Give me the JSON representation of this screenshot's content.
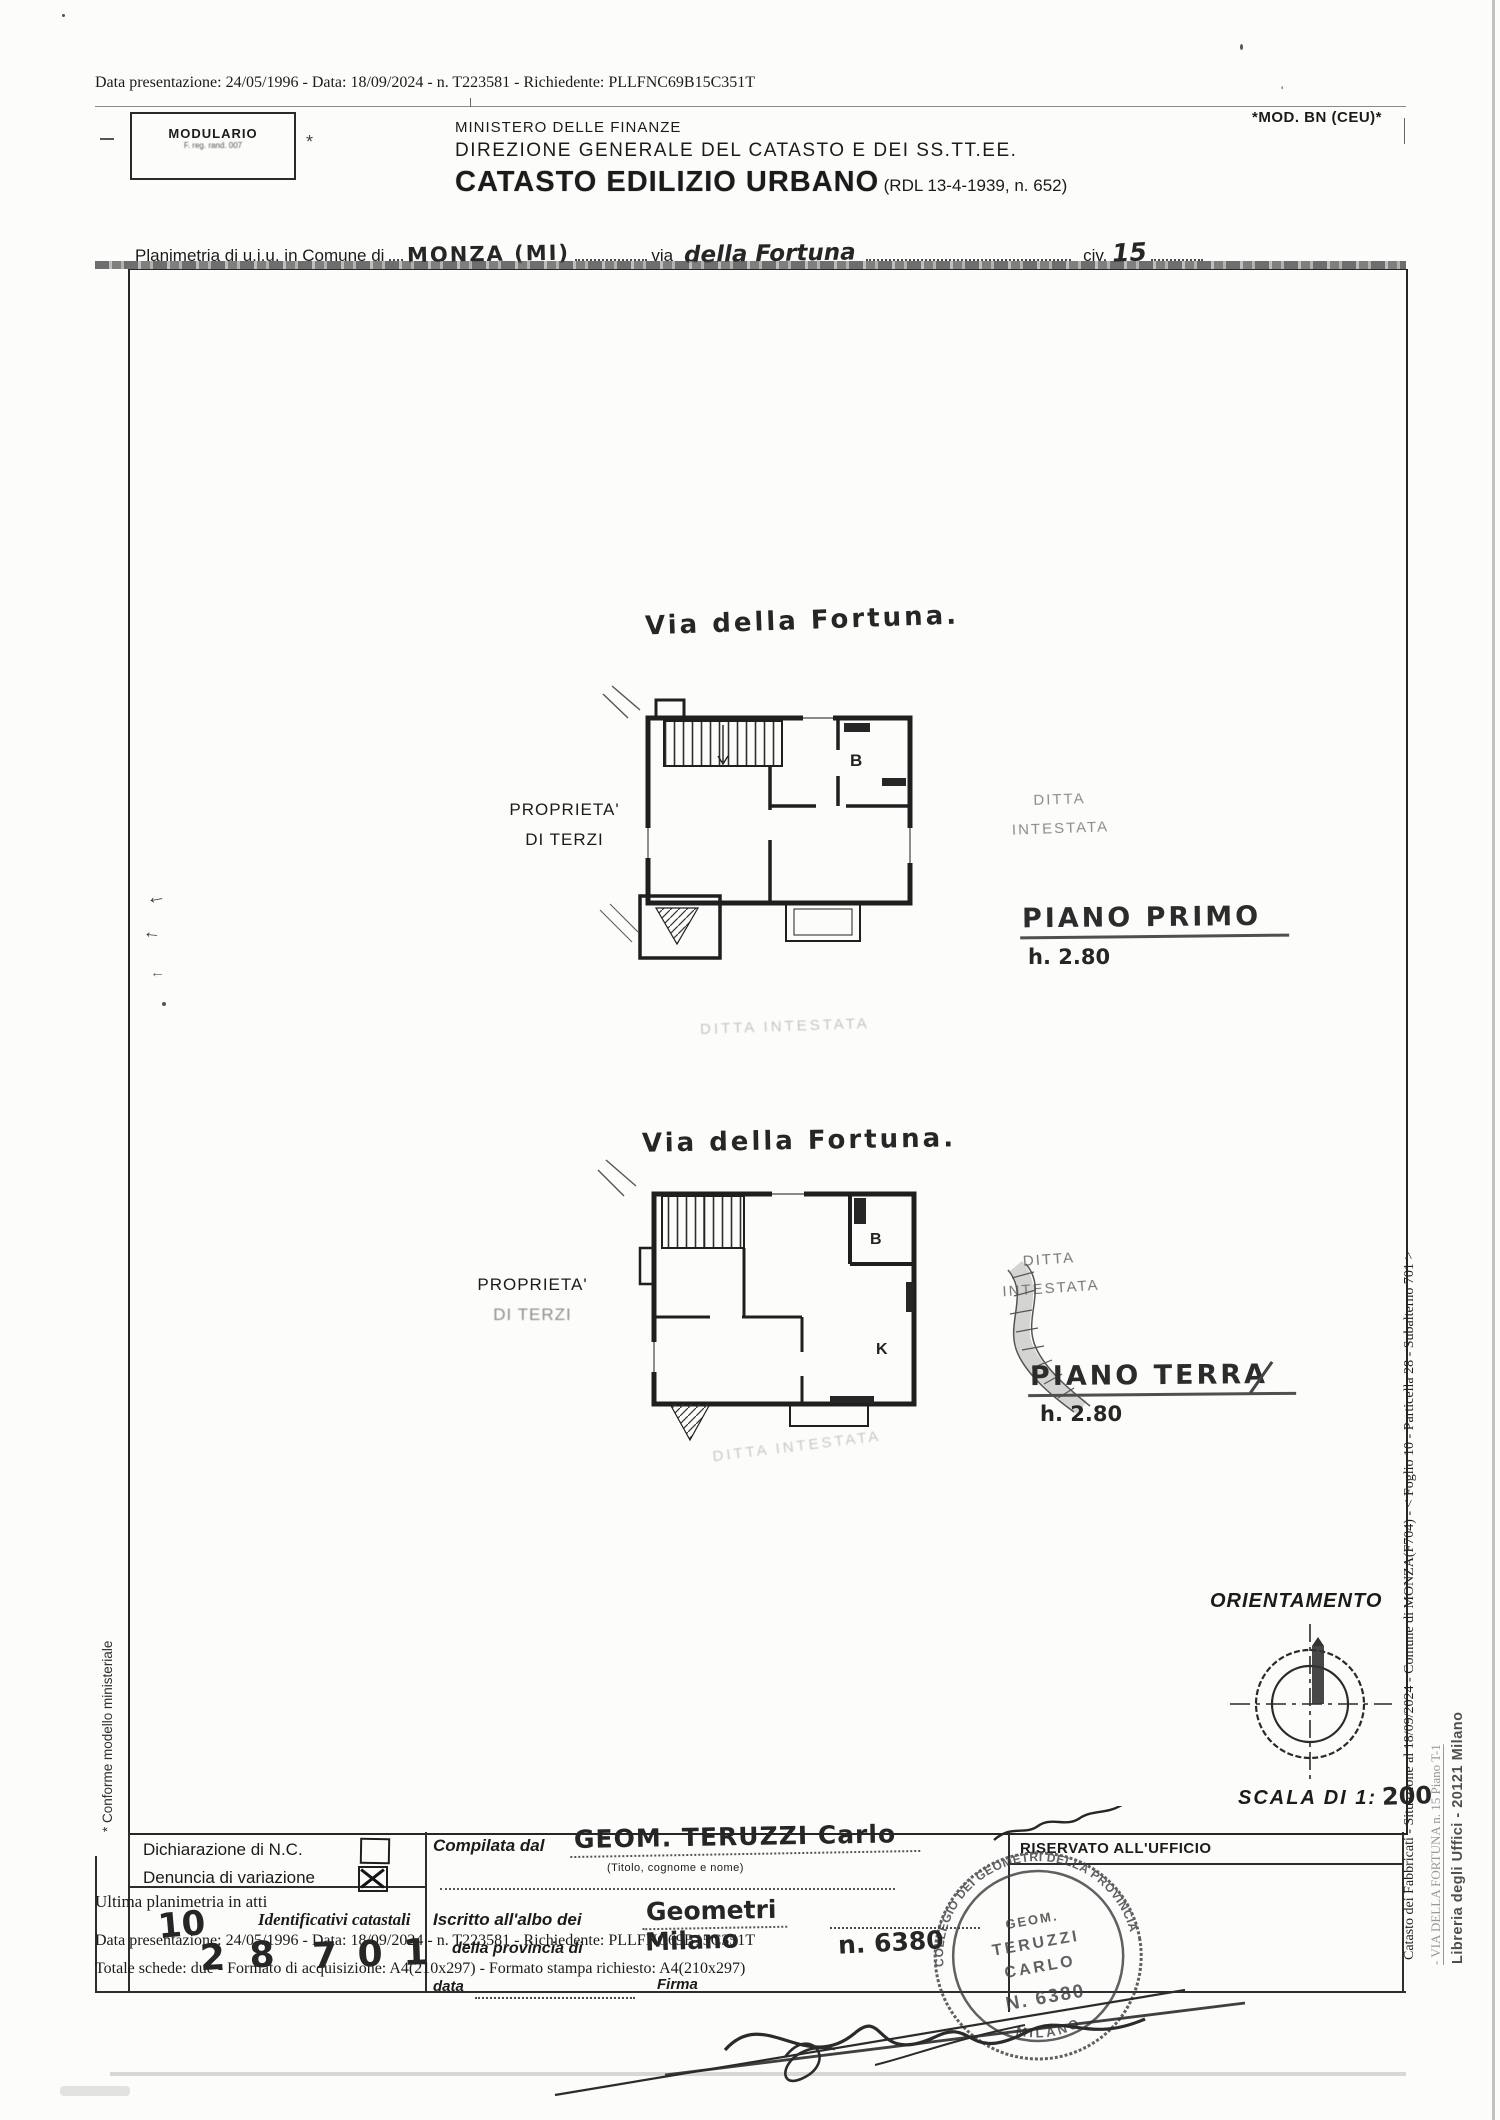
{
  "scan": {
    "top_line": "Data presentazione: 24/05/1996 - Data: 18/09/2024 - n. T223581 - Richiedente: PLLFNC69B15C351T"
  },
  "header": {
    "modulario_title": "MODULARIO",
    "modulario_sub": "F. reg. rand. 007",
    "ministry": "MINISTERO DELLE FINANZE",
    "direction": "DIREZIONE GENERALE DEL CATASTO E DEI SS.TT.EE.",
    "title": "CATASTO EDILIZIO URBANO",
    "title_ref": "(RDL 13-4-1939, n. 652)",
    "mod_code": "*MOD. BN (CEU)*"
  },
  "planimetria": {
    "label1": "Planimetria di u.i.u. in Comune di",
    "comune": "MONZA (MI)",
    "label2": "via",
    "via": "della Fortuna",
    "label3": "civ.",
    "civ": "15"
  },
  "plan_first": {
    "street": "Via della Fortuna.",
    "owner_left_1": "PROPRIETA'",
    "owner_left_2": "DI TERZI",
    "tenant_1": "DITTA",
    "tenant_2": "INTESTATA",
    "floor_name": "PIANO PRIMO",
    "floor_height": "h. 2.80",
    "room_b": "B",
    "faint_label": "DITTA INTESTATA"
  },
  "plan_ground": {
    "street": "Via della Fortuna.",
    "owner_left_1": "PROPRIETA'",
    "owner_left_2": "DI TERZI",
    "tenant_1": "DITTA",
    "tenant_2": "INTESTATA",
    "floor_name": "PIANO TERRA",
    "floor_height": "h. 2.80",
    "room_b": "B",
    "room_k": "K",
    "faint_label": "DITTA INTESTATA"
  },
  "orientation": {
    "label": "ORIENTAMENTO",
    "scale_label": "SCALA DI 1:",
    "scale_value": "200"
  },
  "margins": {
    "left_note": "* Conforme modello ministeriale",
    "right_catasto": "Catasto dei Fabbricati - Situazione al 18/09/2024 - Comune di MONZA(F704) - < Foglio 10 - Particella 28 - Subalterno 701 >",
    "right_via": "- VIA DELLA FORTUNA n. 15 Piano T-1",
    "right_libreria": "Libreria degli Uffici - 20121 Milano"
  },
  "form": {
    "decl_nc": "Dichiarazione di N.C.",
    "decl_var": "Denuncia di variazione",
    "ultima": "Ultima planimetria in atti",
    "identificativi": "Identificativi catastali",
    "overprint_data": "Data presentazione: 24/05/1996 - Data: 18/09/2024 - n. T223581 - Richiedente: PLLFNC69B15C351T",
    "overprint_tot": "Totale schede: due - Formato di acquisizione: A4(210x297) - Formato stampa richiesto: A4(210x297)",
    "hand_foglio": "10",
    "hand_particella": "2 8",
    "hand_subalterno": "7 0 1",
    "compilata": "Compilata dal",
    "compilata_hand": "GEOM. TERUZZI Carlo",
    "titolo_note": "(Titolo, cognome e nome)",
    "iscritto": "Iscritto all'albo dei",
    "iscritto_hand": "Geometri",
    "provincia": "della provincia di",
    "provincia_hand": "Milano",
    "albo_n_hand": "n. 6380",
    "data_label": "data",
    "firma_label": "Firma",
    "riservato": "RISERVATO ALL'UFFICIO"
  },
  "stamp": {
    "ring": "COLLEGIO DEI GEOMETRI DELLA PROVINCIA",
    "center_1": "GEOM.",
    "center_2": "TERUZZI",
    "center_3": "CARLO",
    "center_4": "N. 6380",
    "bottom": "MILANO"
  },
  "colors": {
    "ink": "#1c1c1c",
    "faded": "#9a9a9a",
    "stamp": "#3f3f42"
  }
}
